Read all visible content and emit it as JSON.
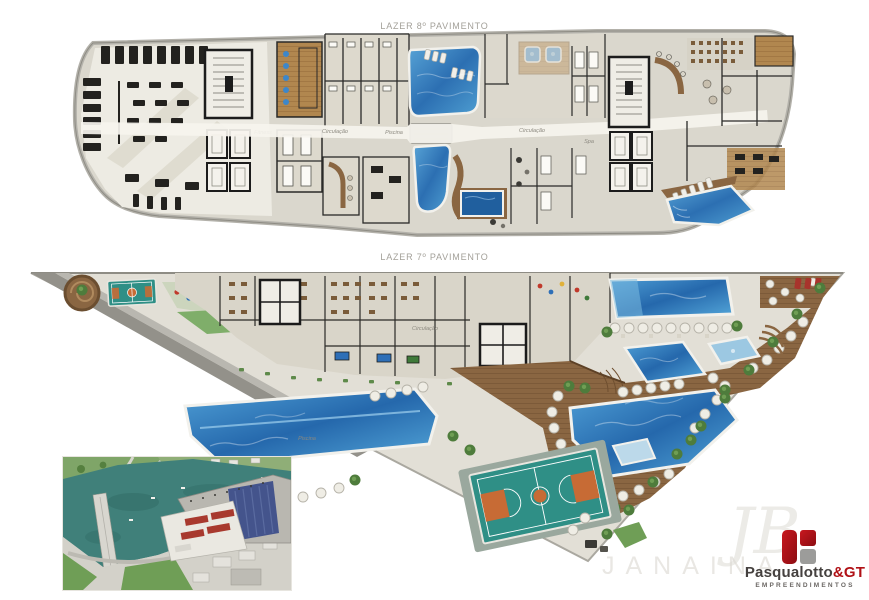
{
  "titles": {
    "floor8": "LAZER 8º PAVIMENTO",
    "floor7": "LAZER 7º PAVIMENTO"
  },
  "floor8": {
    "labels": {
      "fitness": "Fitness",
      "circulacao_left": "Circulação",
      "piscina": "Piscina",
      "circulacao_right": "Circulação",
      "spa": "Spa"
    }
  },
  "floor7": {
    "labels": {
      "circulacao": "Circulação",
      "piscina": "Piscina"
    }
  },
  "logo": {
    "brand_main": "Pasqualotto",
    "brand_accent": "&GT",
    "subtitle": "EMPREENDIMENTOS",
    "watermark_initials": "JB",
    "watermark_name": "JANAINA"
  },
  "colors": {
    "pool_water": "#3d85c6",
    "pool_water_deep": "#205f9e",
    "kids_pool": "#9cc8e2",
    "wood_deck": "#8a6642",
    "wood_floor": "#b1874f",
    "court_surface": "#2f8f86",
    "court_key": "#c76b35",
    "slab_concrete": "#dad7cd",
    "floor_beige": "#ddd9cd",
    "river_water": "#40807a",
    "brand_red": "#b01116",
    "brand_gray": "#9c9c9a",
    "title_gray": "#a3a099"
  }
}
